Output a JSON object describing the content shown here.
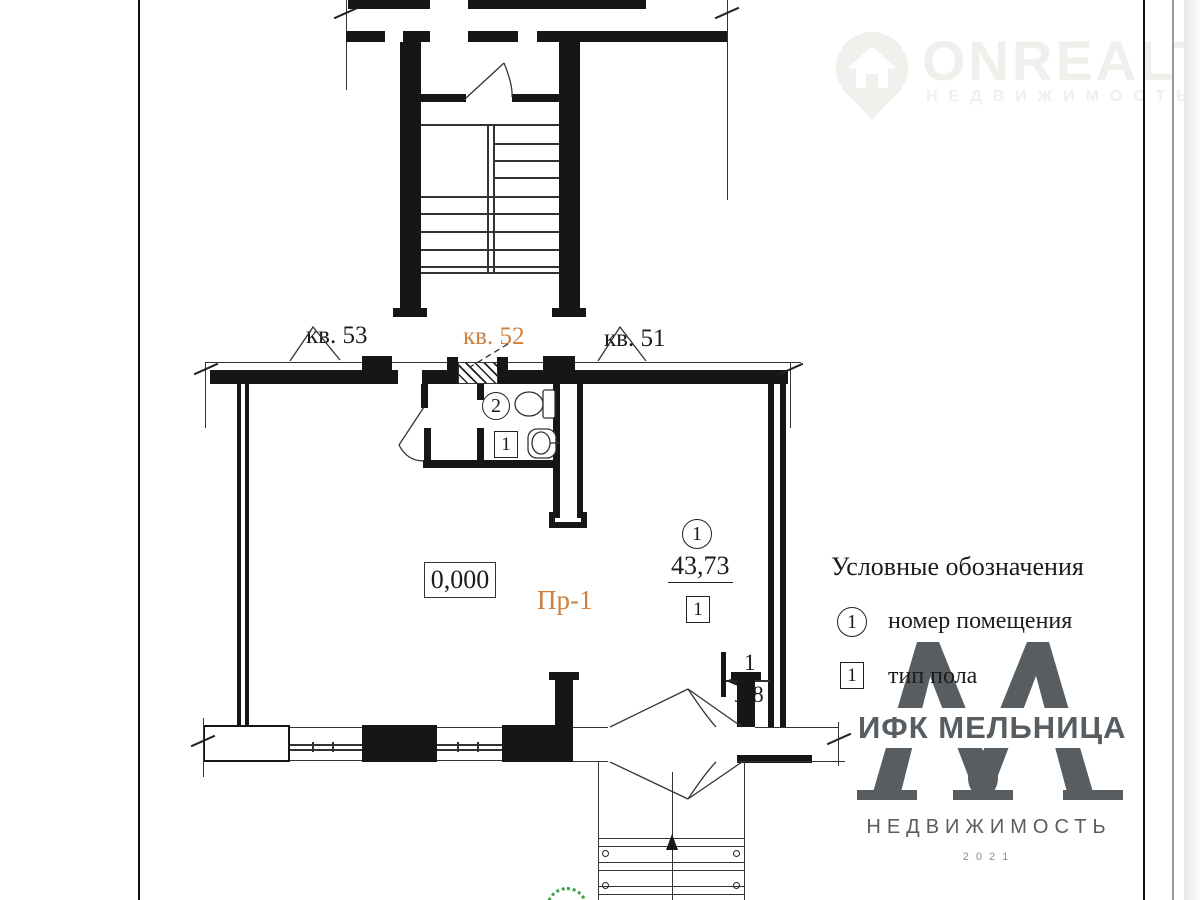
{
  "apartments": {
    "left": "кв. 53",
    "center": "кв. 52",
    "right": "кв. 51"
  },
  "plan": {
    "elevation": "0,000",
    "project_label": "Пр-1",
    "room_main": {
      "number": "1",
      "area": "43,73",
      "floor_type": "1"
    },
    "room_wc": {
      "number": "2",
      "floor_type": "1"
    },
    "level_mark": {
      "top": "1",
      "bottom": "л.8"
    }
  },
  "legend": {
    "title": "Условные обозначения",
    "items": [
      {
        "symbol": "1",
        "shape": "circle",
        "label": "номер помещения"
      },
      {
        "symbol": "1",
        "shape": "square",
        "label": "тип пола"
      }
    ]
  },
  "watermark": {
    "brand": "ONREALT",
    "tagline": "НЕДВИЖИМОСТЬ"
  },
  "company_logo": {
    "name": "ИФК МЕЛЬНИЦА",
    "tagline": "НЕДВИЖИМОСТЬ",
    "year": "2021"
  },
  "colors": {
    "accent": "#cf7f3e",
    "wall": "#161616",
    "logo_gray": "#585d61",
    "stamp_green": "#35a14b"
  }
}
